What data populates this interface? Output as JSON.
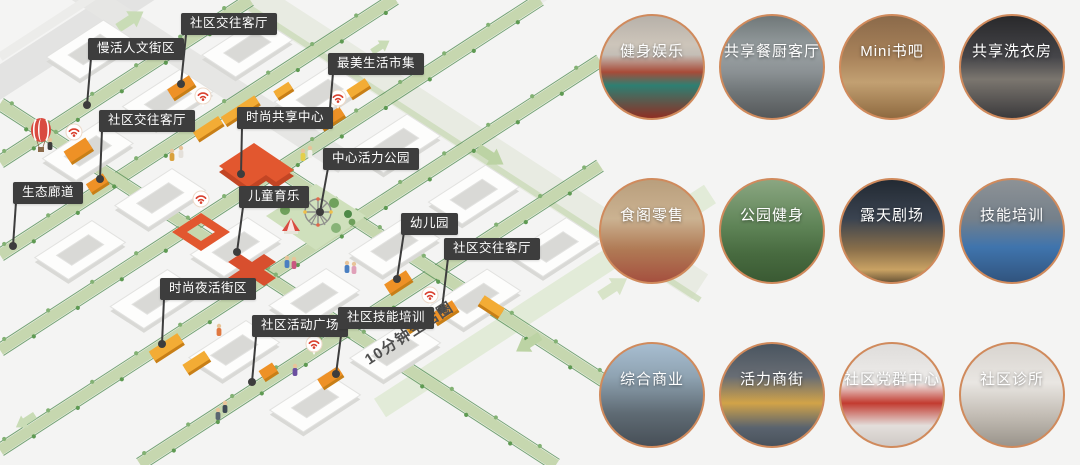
{
  "map": {
    "road_label": "10分钟生活圈",
    "callouts": [
      {
        "label": "社区交往客厅"
      },
      {
        "label": "慢活人文街区"
      },
      {
        "label": "社区交往客厅"
      },
      {
        "label": "最美生活市集"
      },
      {
        "label": "时尚共享中心"
      },
      {
        "label": "中心活力公园"
      },
      {
        "label": "儿童育乐"
      },
      {
        "label": "幼儿园"
      },
      {
        "label": "社区交往客厅"
      },
      {
        "label": "时尚夜活街区"
      },
      {
        "label": "社区活动广场"
      },
      {
        "label": "社区技能培训"
      },
      {
        "label": "生态廊道"
      }
    ],
    "icon_names": [
      "wifi-pin-icon",
      "hot-air-balloon-icon",
      "ferris-wheel-icon",
      "carousel-icon",
      "direction-arrow-icon"
    ]
  },
  "gallery": {
    "items": [
      {
        "label": "健身娱乐"
      },
      {
        "label": "共享餐厨客厅"
      },
      {
        "label": "Mini书吧"
      },
      {
        "label": "共享洗衣房"
      },
      {
        "label": "食阁零售"
      },
      {
        "label": "公园健身"
      },
      {
        "label": "露天剧场"
      },
      {
        "label": "技能培训"
      },
      {
        "label": "综合商业"
      },
      {
        "label": "活力商街"
      },
      {
        "label": "社区党群中心"
      },
      {
        "label": "社区诊所"
      }
    ]
  },
  "colors": {
    "accent_orange": "#ee9126",
    "accent_yellow": "#f3ac35",
    "accent_red": "#dc5330",
    "corridor_green": "#c6d7af",
    "label_bg": "#3d3d3d",
    "circle_border": "#d08a5c"
  }
}
